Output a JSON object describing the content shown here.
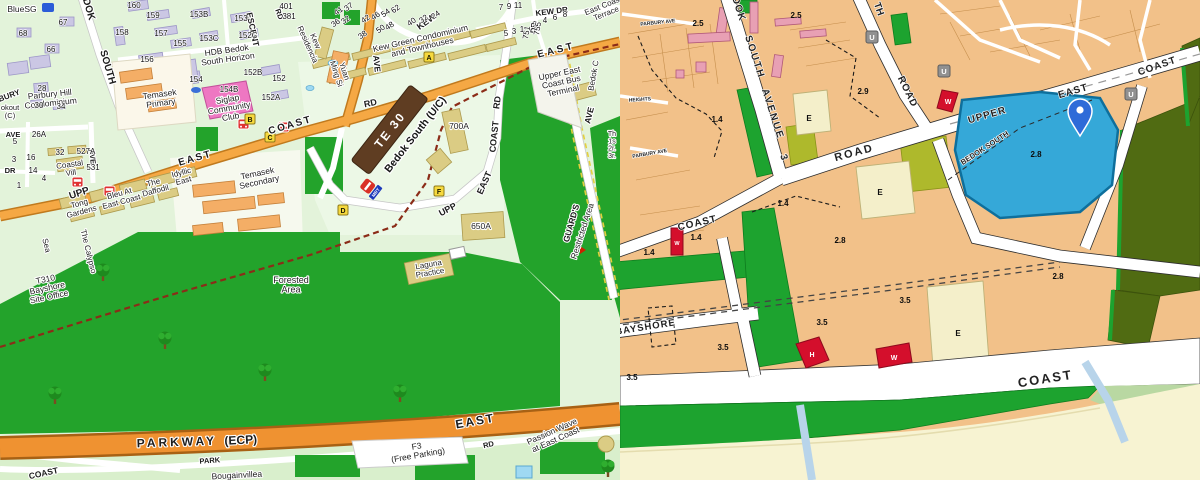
{
  "left_map": {
    "kind": "street-map",
    "station": {
      "code": "TE 30",
      "name": "Bedok South (U/C)",
      "logo": "MRT"
    },
    "stop_markers": [
      "A",
      "B",
      "C",
      "D",
      "F"
    ],
    "road_labels": [
      {
        "t": "UPP",
        "x": 80,
        "y": 196,
        "r": -18,
        "s": 10
      },
      {
        "t": "EAST",
        "x": 196,
        "y": 161,
        "r": -16,
        "s": 10,
        "ls": 2
      },
      {
        "t": "COAST",
        "x": 291,
        "y": 128,
        "r": -16,
        "s": 10,
        "ls": 2
      },
      {
        "t": "EAST",
        "x": 557,
        "y": 53,
        "r": -14,
        "s": 10,
        "ls": 3
      },
      {
        "t": "RD",
        "x": 371,
        "y": 106,
        "r": -12,
        "s": 9
      },
      {
        "t": "UPP",
        "x": 449,
        "y": 212,
        "r": -28,
        "s": 9
      },
      {
        "t": "EAST",
        "x": 487,
        "y": 184,
        "r": -66,
        "s": 9
      },
      {
        "t": "COAST",
        "x": 497,
        "y": 137,
        "r": -84,
        "s": 9
      },
      {
        "t": "RD",
        "x": 500,
        "y": 103,
        "r": -82,
        "s": 9
      },
      {
        "t": "KEW DR",
        "x": 552,
        "y": 14,
        "r": -7,
        "s": 8
      },
      {
        "t": "KEW",
        "x": 428,
        "y": 24,
        "r": -36,
        "s": 9
      },
      {
        "t": "DR",
        "x": 536,
        "y": 28,
        "r": -84,
        "s": 7.5
      },
      {
        "t": "ESCENT",
        "x": 250,
        "y": 30,
        "r": 78,
        "s": 8.5
      },
      {
        "t": "RD",
        "x": 277,
        "y": 15,
        "r": 70,
        "s": 7.5
      },
      {
        "t": "SOUTH",
        "x": 105,
        "y": 68,
        "r": 74,
        "s": 10
      },
      {
        "t": "DOK",
        "x": 86,
        "y": 10,
        "r": 74,
        "s": 10
      },
      {
        "t": "AVE",
        "x": 374,
        "y": 64,
        "r": 84,
        "s": 8.5
      },
      {
        "t": "AVE",
        "x": 592,
        "y": 116,
        "r": -76,
        "s": 8.5
      },
      {
        "t": "GUARD'S",
        "x": 574,
        "y": 224,
        "r": -74,
        "s": 8.5
      },
      {
        "t": "PARKWAY",
        "x": 177,
        "y": 446,
        "r": -2,
        "s": 12,
        "ls": 3
      },
      {
        "t": "(ECP)",
        "x": 241,
        "y": 444,
        "r": -3,
        "s": 12
      },
      {
        "t": "EAST",
        "x": 476,
        "y": 425,
        "r": -10,
        "s": 12,
        "ls": 2
      },
      {
        "t": "PARK",
        "x": 210,
        "y": 463,
        "r": -4,
        "s": 7.5
      },
      {
        "t": "RD",
        "x": 489,
        "y": 447,
        "r": -13,
        "s": 7.5
      },
      {
        "t": "COAST",
        "x": 44,
        "y": 476,
        "r": -12,
        "s": 8.5
      },
      {
        "t": "AVE",
        "x": 13,
        "y": 137,
        "s": 7.5
      },
      {
        "t": "DR",
        "x": 10,
        "y": 173,
        "s": 7.5
      },
      {
        "t": "AVE",
        "x": 90,
        "y": 157,
        "r": 84,
        "s": 7.5
      },
      {
        "t": "BURY",
        "x": 10,
        "y": 98,
        "r": -20,
        "s": 8
      }
    ],
    "place_labels": [
      {
        "t": "BlueSG",
        "x": 22,
        "y": 12,
        "s": 8.5
      },
      {
        "lines": [
          "HDB Bedok",
          "South Horizon"
        ],
        "x": 227,
        "y": 53,
        "r": -8,
        "s": 8.5
      },
      {
        "lines": [
          "Parbury Hill",
          "Condominium"
        ],
        "x": 50,
        "y": 97,
        "r": -6,
        "s": 8.5
      },
      {
        "lines": [
          "Temasek",
          "Primary"
        ],
        "x": 160,
        "y": 97,
        "r": -8,
        "s": 8.5
      },
      {
        "lines": [
          "Siglap",
          "Community",
          "Club"
        ],
        "x": 228,
        "y": 102,
        "r": -10,
        "s": 8.5
      },
      {
        "lines": [
          "Kew",
          "Residencia"
        ],
        "x": 313,
        "y": 42,
        "r": 66,
        "s": 8
      },
      {
        "lines": [
          "Yuan",
          "Ming Si"
        ],
        "x": 342,
        "y": 72,
        "r": 72,
        "s": 8
      },
      {
        "lines": [
          "Kew Green Condominium",
          "and Townhouses"
        ],
        "x": 421,
        "y": 41,
        "r": -13,
        "s": 8.5
      },
      {
        "lines": [
          "Upper East",
          "Coast Bus",
          "Terminal"
        ],
        "x": 560,
        "y": 76,
        "r": -12,
        "s": 8.5
      },
      {
        "lines": [
          "East Coast",
          "Terrace"
        ],
        "x": 604,
        "y": 8,
        "r": -22,
        "s": 8
      },
      {
        "lines": [
          "Temasek",
          "Secondary"
        ],
        "x": 258,
        "y": 176,
        "r": -12,
        "s": 8.5
      },
      {
        "lines": [
          "Coastal",
          "Vill"
        ],
        "x": 70,
        "y": 167,
        "r": -8,
        "s": 8
      },
      {
        "lines": [
          "Tong",
          "Gardens"
        ],
        "x": 80,
        "y": 206,
        "r": -15,
        "s": 8
      },
      {
        "lines": [
          "Bleu At",
          "East Coast"
        ],
        "x": 120,
        "y": 196,
        "r": -15,
        "s": 8
      },
      {
        "lines": [
          "The",
          "Daffodil"
        ],
        "x": 154,
        "y": 185,
        "r": -15,
        "s": 8
      },
      {
        "lines": [
          "Idyllic",
          "East"
        ],
        "x": 182,
        "y": 175,
        "r": -15,
        "s": 8
      },
      {
        "lines": [
          "T310",
          "Bayshore",
          "Site Office"
        ],
        "x": 46,
        "y": 282,
        "r": -12,
        "s": 8.5
      },
      {
        "lines": [
          "Forested",
          "Area"
        ],
        "x": 291,
        "y": 283,
        "s": 9
      },
      {
        "lines": [
          "Laguna",
          "Practice"
        ],
        "x": 429,
        "y": 267,
        "r": -10,
        "s": 8
      },
      {
        "t": "700A",
        "x": 459,
        "y": 129,
        "s": 8.5
      },
      {
        "t": "650A",
        "x": 481,
        "y": 229,
        "s": 8.5
      },
      {
        "lines": [
          "F3",
          "(Free Parking)"
        ],
        "x": 417,
        "y": 449,
        "r": -10,
        "s": 8.5
      },
      {
        "t": "Bougainvillea",
        "x": 237,
        "y": 478,
        "r": -3,
        "s": 8.5,
        "f": "#1a7a1a"
      },
      {
        "lines": [
          "Passion Wave",
          "at East Coast"
        ],
        "x": 553,
        "y": 434,
        "r": -24,
        "s": 8.5,
        "f": "#1a7a1a"
      },
      {
        "t": "Restricted Area",
        "x": 585,
        "y": 232,
        "r": -72,
        "s": 8.5,
        "f": "#cc2200"
      },
      {
        "t": "Bedok C",
        "x": 596,
        "y": 76,
        "r": -80,
        "s": 8,
        "f": "#cc2200"
      },
      {
        "t": "The Calypso",
        "x": 86,
        "y": 252,
        "r": 76,
        "s": 8
      },
      {
        "t": "Sea",
        "x": 44,
        "y": 246,
        "r": 76,
        "s": 8
      },
      {
        "lines": [
          "okout",
          "(C)"
        ],
        "x": 10,
        "y": 110,
        "s": 7.5
      },
      {
        "lines": [
          "Th",
          "1s",
          "2r.",
          "3r."
        ],
        "x": 612,
        "y": 136,
        "s": 7
      }
    ],
    "street_numbers": [
      {
        "t": "160",
        "x": 134,
        "y": 8
      },
      {
        "t": "159",
        "x": 153,
        "y": 18
      },
      {
        "t": "157",
        "x": 161,
        "y": 36
      },
      {
        "t": "155",
        "x": 180,
        "y": 46
      },
      {
        "t": "158",
        "x": 122,
        "y": 35
      },
      {
        "t": "156",
        "x": 147,
        "y": 62
      },
      {
        "t": "153B",
        "x": 199,
        "y": 17
      },
      {
        "t": "153",
        "x": 241,
        "y": 21
      },
      {
        "t": "153C",
        "x": 209,
        "y": 41
      },
      {
        "t": "152C",
        "x": 248,
        "y": 38
      },
      {
        "t": "154",
        "x": 196,
        "y": 82
      },
      {
        "t": "154B",
        "x": 229,
        "y": 92
      },
      {
        "t": "152B",
        "x": 253,
        "y": 75
      },
      {
        "t": "152",
        "x": 279,
        "y": 81
      },
      {
        "t": "152A",
        "x": 271,
        "y": 100
      },
      {
        "t": "67",
        "x": 63,
        "y": 25
      },
      {
        "t": "68",
        "x": 23,
        "y": 36
      },
      {
        "t": "66",
        "x": 51,
        "y": 52
      },
      {
        "t": "28",
        "x": 42,
        "y": 91
      },
      {
        "t": "30",
        "x": 39,
        "y": 108
      },
      {
        "t": "34",
        "x": 61,
        "y": 109
      },
      {
        "t": "401",
        "x": 286,
        "y": 9
      },
      {
        "t": "381",
        "x": 289,
        "y": 19
      },
      {
        "t": "26A",
        "x": 39,
        "y": 137
      },
      {
        "t": "527A",
        "x": 86,
        "y": 154
      },
      {
        "t": "32",
        "x": 60,
        "y": 155
      },
      {
        "t": "531",
        "x": 93,
        "y": 170
      },
      {
        "t": "16",
        "x": 31,
        "y": 160
      },
      {
        "t": "14",
        "x": 33,
        "y": 173
      },
      {
        "t": "3",
        "x": 14,
        "y": 162
      },
      {
        "t": "5",
        "x": 15,
        "y": 144
      },
      {
        "t": "4",
        "x": 44,
        "y": 181
      },
      {
        "t": "1",
        "x": 19,
        "y": 188
      },
      {
        "t": "41",
        "x": 340,
        "y": 13,
        "r": -35
      },
      {
        "t": "37",
        "x": 350,
        "y": 9,
        "r": -35
      },
      {
        "t": "36",
        "x": 337,
        "y": 25,
        "r": -35
      },
      {
        "t": "32",
        "x": 347,
        "y": 22,
        "r": -35
      },
      {
        "t": "42",
        "x": 367,
        "y": 21,
        "r": -35
      },
      {
        "t": "46",
        "x": 377,
        "y": 18,
        "r": -35
      },
      {
        "t": "54",
        "x": 387,
        "y": 15,
        "r": -35
      },
      {
        "t": "62",
        "x": 397,
        "y": 11,
        "r": -35
      },
      {
        "t": "50",
        "x": 382,
        "y": 31,
        "r": -35
      },
      {
        "t": "48",
        "x": 391,
        "y": 28,
        "r": -35
      },
      {
        "t": "40",
        "x": 413,
        "y": 24,
        "r": -35
      },
      {
        "t": "32",
        "x": 425,
        "y": 21,
        "r": -35
      },
      {
        "t": "24",
        "x": 437,
        "y": 17,
        "r": -35
      },
      {
        "t": "38",
        "x": 364,
        "y": 37,
        "r": -35
      },
      {
        "t": "7",
        "x": 501,
        "y": 10
      },
      {
        "t": "9",
        "x": 509,
        "y": 9
      },
      {
        "t": "11",
        "x": 518,
        "y": 8
      },
      {
        "t": "5",
        "x": 506,
        "y": 36
      },
      {
        "t": "3",
        "x": 514,
        "y": 34
      },
      {
        "t": "1",
        "x": 522,
        "y": 32
      },
      {
        "t": "2",
        "x": 535,
        "y": 27
      },
      {
        "t": "4",
        "x": 545,
        "y": 23
      },
      {
        "t": "6",
        "x": 555,
        "y": 20
      },
      {
        "t": "8",
        "x": 565,
        "y": 17
      },
      {
        "t": "751",
        "x": 529,
        "y": 33,
        "r": -80
      },
      {
        "t": "755",
        "x": 540,
        "y": 29,
        "r": -80
      }
    ]
  },
  "right_map": {
    "kind": "master-plan-map",
    "road_labels": [
      {
        "t": "DOK",
        "x": 736,
        "y": 10,
        "r": 72,
        "s": 10,
        "ls": 1
      },
      {
        "t": "SOUTH",
        "x": 752,
        "y": 58,
        "r": 72,
        "s": 10,
        "ls": 2
      },
      {
        "t": "AVENUE",
        "x": 770,
        "y": 115,
        "r": 72,
        "s": 10,
        "ls": 2
      },
      {
        "t": "3",
        "x": 781,
        "y": 158,
        "r": 72,
        "s": 10
      },
      {
        "t": "ROAD",
        "x": 855,
        "y": 156,
        "r": -15,
        "s": 11,
        "ls": 2
      },
      {
        "t": "TH",
        "x": 876,
        "y": 10,
        "r": 70,
        "s": 10
      },
      {
        "t": "ROAD",
        "x": 905,
        "y": 93,
        "r": 64,
        "s": 10,
        "ls": 1
      },
      {
        "t": "COAST",
        "x": 698,
        "y": 226,
        "r": -13,
        "s": 10,
        "ls": 1
      },
      {
        "t": "UPPER",
        "x": 988,
        "y": 118,
        "r": -16,
        "s": 10,
        "ls": 1
      },
      {
        "t": "EAST",
        "x": 1074,
        "y": 94,
        "r": -16,
        "s": 10,
        "ls": 1
      },
      {
        "t": "COAST",
        "x": 1158,
        "y": 69,
        "r": -19,
        "s": 10,
        "ls": 1
      },
      {
        "t": "BEDOK SOUTH",
        "x": 986,
        "y": 150,
        "r": -33,
        "s": 7.5
      },
      {
        "t": "BAYSHORE",
        "x": 646,
        "y": 330,
        "r": -9,
        "s": 9.5,
        "ls": 1
      },
      {
        "t": "COAST",
        "x": 1046,
        "y": 383,
        "r": -9,
        "s": 13,
        "ls": 2
      },
      {
        "t": "HEIGHTS",
        "x": 640,
        "y": 101,
        "r": -4,
        "s": 5
      },
      {
        "t": "PARBURY AVE",
        "x": 658,
        "y": 24,
        "r": -6,
        "s": 5
      },
      {
        "t": "PARBURY AVE",
        "x": 650,
        "y": 155,
        "r": -10,
        "s": 5
      }
    ],
    "plot_ratios": [
      {
        "t": "2.5",
        "x": 698,
        "y": 26
      },
      {
        "t": "2.5",
        "x": 796,
        "y": 18
      },
      {
        "t": "2.9",
        "x": 863,
        "y": 94
      },
      {
        "t": "1.4",
        "x": 717,
        "y": 122
      },
      {
        "t": "1.4",
        "x": 613,
        "y": 190
      },
      {
        "t": "1.4",
        "x": 783,
        "y": 206
      },
      {
        "t": "1.4",
        "x": 696,
        "y": 240
      },
      {
        "t": "1.4",
        "x": 649,
        "y": 255
      },
      {
        "t": "2.8",
        "x": 840,
        "y": 243
      },
      {
        "t": "2.8",
        "x": 1036,
        "y": 157
      },
      {
        "t": "2.8",
        "x": 1058,
        "y": 279
      },
      {
        "t": "3.5",
        "x": 611,
        "y": 308
      },
      {
        "t": "3.5",
        "x": 822,
        "y": 325
      },
      {
        "t": "3.5",
        "x": 723,
        "y": 350
      },
      {
        "t": "3.5",
        "x": 632,
        "y": 380
      },
      {
        "t": "3.5",
        "x": 905,
        "y": 303
      },
      {
        "t": "E",
        "x": 809,
        "y": 121
      },
      {
        "t": "E",
        "x": 880,
        "y": 195
      },
      {
        "t": "E",
        "x": 958,
        "y": 336
      }
    ],
    "utility_letters": [
      "U",
      "U",
      "U"
    ],
    "red_plot_letters": [
      "W",
      "W",
      "H",
      "W"
    ]
  },
  "colors": {
    "left_background": "#e3f3da",
    "forest_green": "#23a32b",
    "main_road_orange": "#f5a844",
    "expressway_orange": "#ef9231",
    "tel_line_brown": "#5f3d22",
    "tel_dashed": "#8b2c18",
    "hdb_building_purple": "#cbc7e4",
    "landed_building_khaki": "#dbcc84",
    "school_building_orange": "#f4ae66",
    "community_club_pink": "#ee77c2",
    "water_blue": "#9fd9f2",
    "bus_stop_red": "#e03232",
    "marker_yellow": "#f6d93e",
    "restricted_red_text": "#cc2200",
    "right_residential_tan": "#f2c189",
    "right_park_green": "#1da32f",
    "right_open_space_olive": "#506b12",
    "right_beach_cream": "#f7f3d2",
    "right_waterbody_blue": "#35a8d8",
    "right_education_cream": "#f4efca",
    "right_civic_lime": "#aeb92c",
    "right_commercial_red": "#d40f2c",
    "right_utility_gray": "#919191",
    "right_pale_green": "#b9d8a2",
    "pin_blue": "#2e6bd8"
  }
}
